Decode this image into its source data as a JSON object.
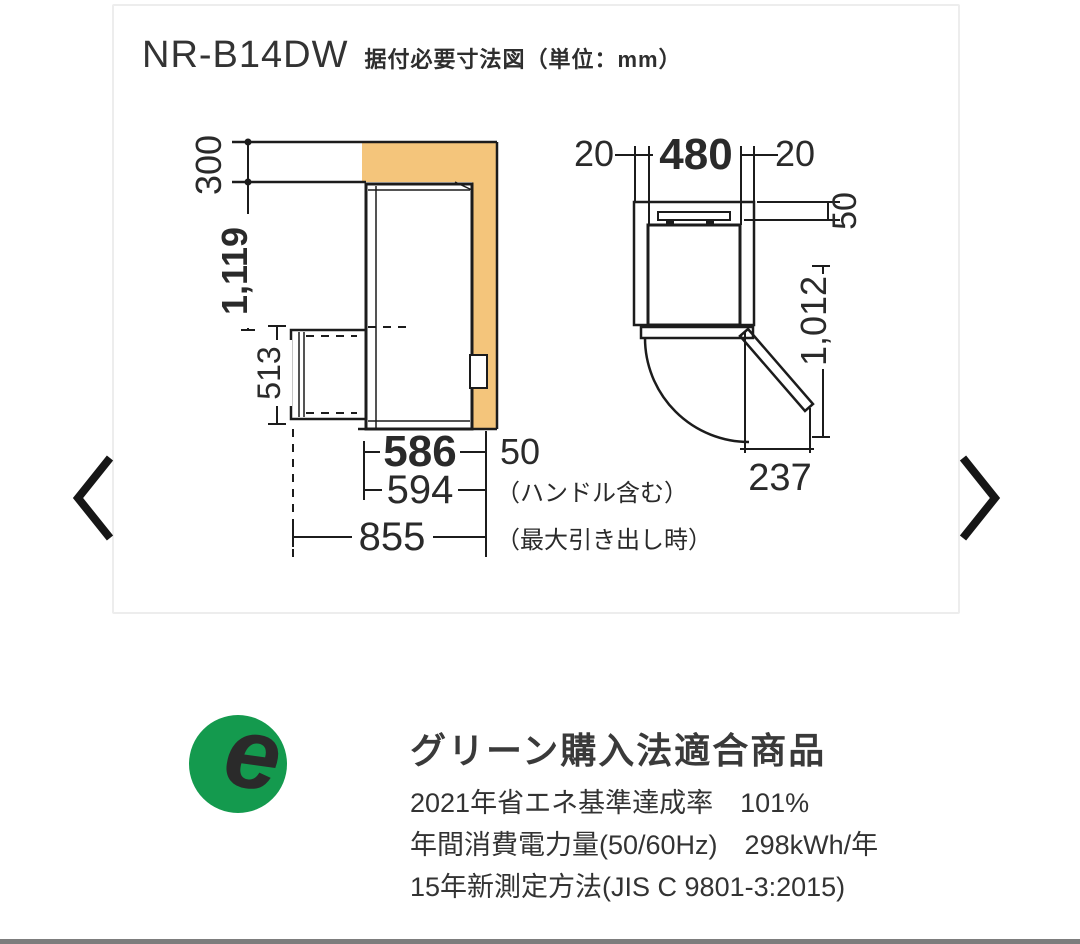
{
  "header": {
    "model": "NR-B14DW",
    "caption": "据付必要寸法図（単位：mm）"
  },
  "front_view": {
    "top_clearance": "300",
    "height": "1,119",
    "drawer_open_height": "513",
    "body_width": "586",
    "right_clearance": "50",
    "width_including_handle": "594",
    "handle_note": "（ハンドル含む）",
    "max_pullout_width": "855",
    "pullout_note": "（最大引き出し時）"
  },
  "top_view": {
    "left_wall_gap": "20",
    "body_width": "480",
    "right_wall_gap": "20",
    "rear_gap": "50",
    "depth_door_open": "1,012",
    "door_open_width": "237"
  },
  "eco": {
    "logo_letter": "e",
    "heading": "グリーン購入法適合商品",
    "lines": [
      "2021年省エネ基準達成率　101%",
      "年間消費電力量(50/60Hz)　298kWh/年",
      "15年新測定方法(JIS C 9801-3:2015)"
    ]
  },
  "colors": {
    "clearance_orange": "#f4c57b",
    "dimension_blue": "#215a84",
    "eco_green": "#149a4e"
  }
}
